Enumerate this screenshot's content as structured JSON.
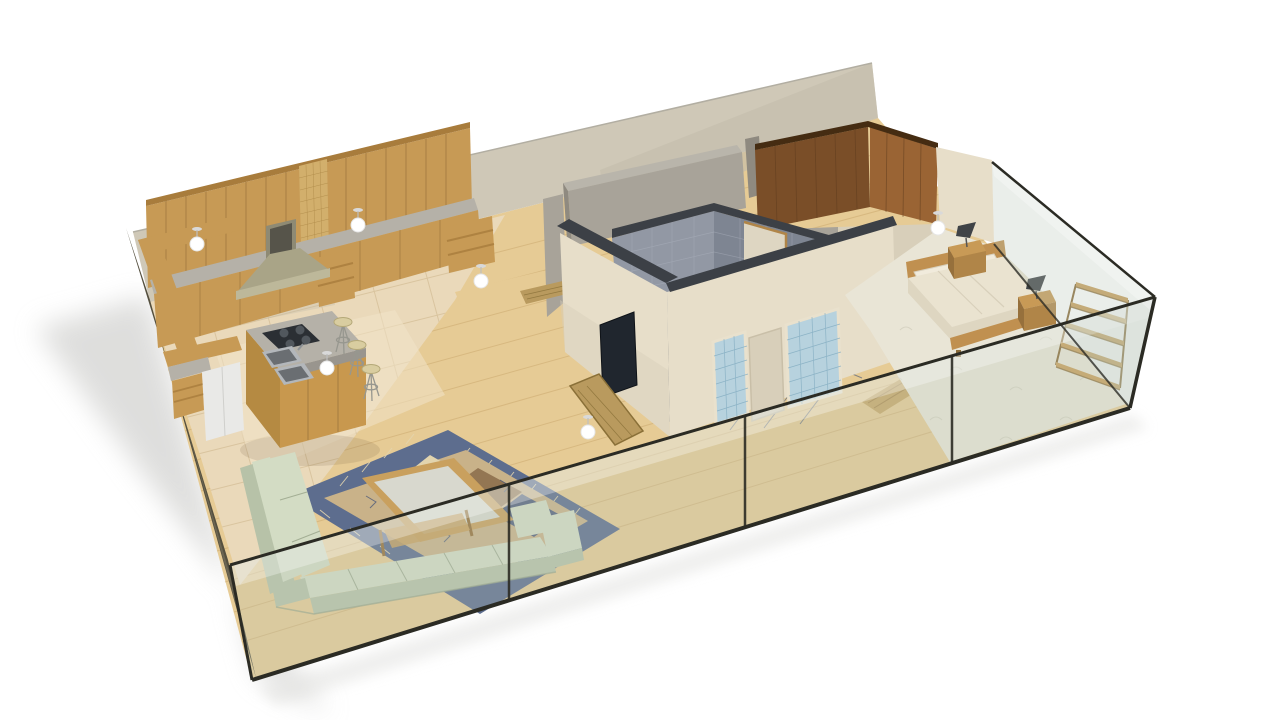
{
  "meta": {
    "title": "3D apartment floor-plan cutaway render",
    "style": "isometric dollhouse view on white background, soft shadow to lower-left"
  },
  "scene": {
    "rooms": [
      {
        "name": "Kitchen",
        "position": "back-left",
        "features": [
          "wood upper and base cabinets",
          "gold mosaic backsplash",
          "granite counters",
          "island with cooktop and double sink",
          "pyramid range hood",
          "3 bar stools",
          "L-shaped wood bar ledge",
          "white fridge cabinet",
          "beige tile floor"
        ]
      },
      {
        "name": "Living Room",
        "position": "front-left",
        "features": [
          "sage green L-shaped sectional sofa",
          "wood coffee table with glass top",
          "blue patterned area rug",
          "light oak plank floor",
          "wall-mounted TV on bathroom wall"
        ]
      },
      {
        "name": "Bathroom",
        "position": "center",
        "features": [
          "gray tiled walls",
          "dark diamond tile floor",
          "door to hallway",
          "two towel radiators",
          "glass shower screen",
          "white tub edge",
          "blue glass-block panels on outer wall"
        ]
      },
      {
        "name": "Hallway / Entry",
        "position": "back-center",
        "features": [
          "gray partition walls",
          "wood floor",
          "wood runner mats"
        ]
      },
      {
        "name": "Walk-in Closet",
        "position": "back-right",
        "features": [
          "brown wood paneling",
          "door from bedroom"
        ]
      },
      {
        "name": "Bedroom",
        "position": "right",
        "features": [
          "double bed with cream duvet",
          "two wood nightstands with black lamps",
          "wood ladder wall shelf",
          "cream patterned carpet",
          "wood threshold strip"
        ]
      }
    ],
    "envelope": {
      "front": "full-height tinted glass wall, dark frame, 3 mullions",
      "left": "dark tinted glass wall",
      "right": "tinted glass wall",
      "back": "beige plaster wall"
    },
    "lighting": {
      "ceiling_pendant_count": 6
    }
  },
  "colors": {
    "bg": "#ffffff",
    "shadow": "#d6d6d4",
    "reflect": "#e3e3e1",
    "wood_floor": "#e6cb95",
    "wood_floor_line": "#c6a267",
    "tile_floor": "#ead9ba",
    "tile_line": "#d6c09a",
    "tile_rug": "#f1e4c8",
    "back_wall": "#cfc8b7",
    "back_wall_shade": "#c3bcab",
    "wall_top_line": "#b2aea2",
    "left_glass_dark": "#55503f",
    "left_glass_dark2": "#79735f",
    "cabinet_wood": "#c79a55",
    "cabinet_wood_dark": "#a87c3c",
    "cabinet_line": "#96703a",
    "mosaic": "#d2af6c",
    "mosaic_line": "#b08c4a",
    "counter_granite": "#b5b1a8",
    "granite_dark": "#99958e",
    "hood_metal": "#a9a487",
    "hood_light": "#bdb89a",
    "hood_mid": "#8e8a74",
    "hood_dark": "#56544a",
    "island_wood": "#c8984e",
    "island_wood_dark": "#b58a42",
    "cooktop": "#2b2f34",
    "burner": "#51575d",
    "sink_steel": "#b3b7bb",
    "sink_dark": "#6a6e72",
    "stool_seat": "#d9cda0",
    "stool_leg": "#97978f",
    "fridge_white": "#e9e9e7",
    "gray_wall": "#a8a399",
    "gray_wall_dark": "#8f8a80",
    "gray_wall_light": "#b9b5ab",
    "closet_wood_dark": "#7a4e28",
    "closet_wood": "#9a6434",
    "closet_line": "#5f3c1e",
    "closet_top": "#452c12",
    "cream_wall": "#e7dec9",
    "cream_wall_shade": "#d8cfba",
    "wall_dark_top": "#3c4046",
    "bath_tile_wall": "#9298a4",
    "bath_tile_wall2": "#7e8592",
    "bath_tile_line": "#aab0bc",
    "bath_floor": "#454c5b",
    "bath_floor_line": "#6a7180",
    "bath_floor_light": "#7c8291",
    "door_lit": "#ded6c2",
    "door_frame": "#b08548",
    "radiator": "#4a4e55",
    "radiator_slat": "#9aa0a8",
    "shower_glass": "#c2ccd2",
    "tub_white": "#f2f2ee",
    "tv_screen": "#20262e",
    "blue_mosaic": "#b7d2de",
    "blue_mosaic_line": "#85aec2",
    "panel_frame": "#e9e1cd",
    "threshold": "#c9a868",
    "threshold_line": "#a8854e",
    "carpet": "#e9e5d6",
    "carpet_pattern": "#c6c2af",
    "bed_duvet": "#eae3d0",
    "bed_duvet_side": "#ded6c1",
    "bed_fold": "#d6cdb8",
    "bed_wood": "#c09050",
    "pillow": "#f1ebdc",
    "lamp_dark": "#3f4347",
    "nightstand": "#b08548",
    "nightstand_top": "#c89a56",
    "nightstand_side": "#96703c",
    "shelf_wood": "#c9a05e",
    "shelf_wood_dark": "#8a6b38",
    "sofa_top": "#d3dcc4",
    "sofa_front": "#b7c2a8",
    "sofa_shadow": "#97a388",
    "rug_blue": "#5d6d8e",
    "rug_blue_dark": "#47557a",
    "rug_tan": "#c9b289",
    "rug_brown": "#8a6b4a",
    "rug_navy": "#55617f",
    "rug_cream": "#e2d4ae",
    "table_wood": "#c9a05e",
    "table_glass": "#dce6ea",
    "glass_fill": "#b9c8bb",
    "glass_hi": "#ffffff",
    "glass_edge": "#2b2b24",
    "mat_wood": "#b99a5e",
    "mat_border": "#8a7038",
    "light_white": "#ffffff",
    "light_gray": "#d9d9d9",
    "stem": "#bfbfbf",
    "smudge": "#b98f54"
  }
}
